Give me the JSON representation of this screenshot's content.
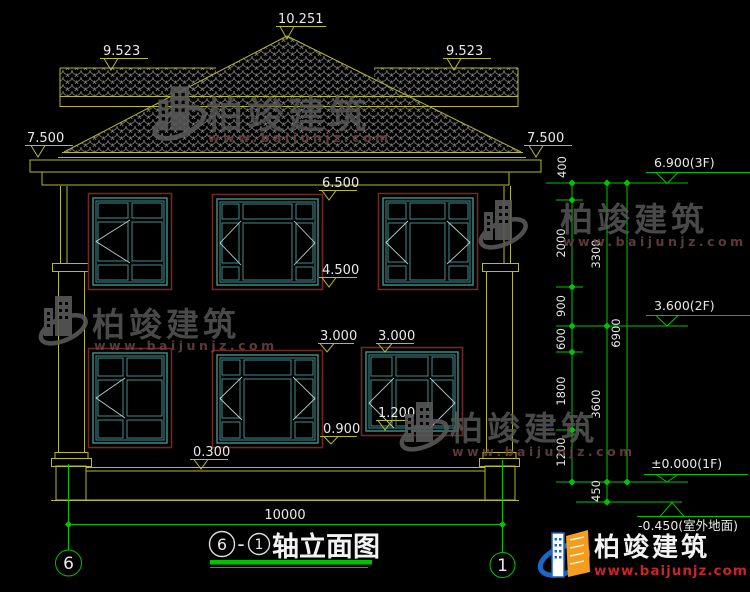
{
  "facade_annotations": {
    "ridge": "10.251",
    "side_ridge_left": "9.523",
    "side_ridge_right": "9.523",
    "eave_left": "7.500",
    "eave_right": "7.500",
    "floor2_window_top": "6.500",
    "floor2_window_sill": "4.500",
    "floor1_window_top_mid": "3.000",
    "floor1_window_top_right": "3.000",
    "floor1_window_sill_right": "1.200",
    "floor1_window_sill_mid": "0.900",
    "plinth_top": "0.300"
  },
  "right_dimensions": {
    "inner_chain": {
      "seg_400": "400",
      "seg_2000": "2000",
      "seg_900": "900",
      "seg_600": "600",
      "seg_1800": "1800",
      "seg_1200": "1200"
    },
    "middle_chain": {
      "seg_3300": "3300",
      "seg_3600": "3600",
      "seg_450": "450"
    },
    "outer_chain": {
      "seg_6900": "6900"
    }
  },
  "level_markers": {
    "roof": "6.900(3F)",
    "floor2": "3.600(2F)",
    "floor1": "±0.000(1F)",
    "ground": "-0.450(室外地面)"
  },
  "bottom_dimension": {
    "total_width": "10000"
  },
  "axis_grid": {
    "left": "6",
    "right": "1"
  },
  "title_block": {
    "bubble_left": "6",
    "separator": "-",
    "bubble_right": "1",
    "title": "轴立面图"
  },
  "watermark": {
    "brand": "柏竣建筑",
    "website": "www.baijunjz.com"
  },
  "logo": {
    "brand": "柏竣建筑",
    "website": "www.baijunjz.com"
  },
  "colors": {
    "background": "#000000",
    "line_yellow": "#b9b92a",
    "line_green": "#00c300",
    "text_white": "#e9e9e9",
    "window_frame": "#3f9494",
    "window_sash": "#4a9c9c",
    "window_trim": "#6e2a22",
    "casement": "#b9cfcf",
    "tile_gray": "#7a7a7a",
    "brick_gray": "#8d8d8d",
    "watermark_gray": "#595959",
    "watermark_red": "#6e4444",
    "logo_blue": "#1e66c5",
    "logo_orange": "#f59d1f",
    "logo_red": "#c5252a"
  }
}
